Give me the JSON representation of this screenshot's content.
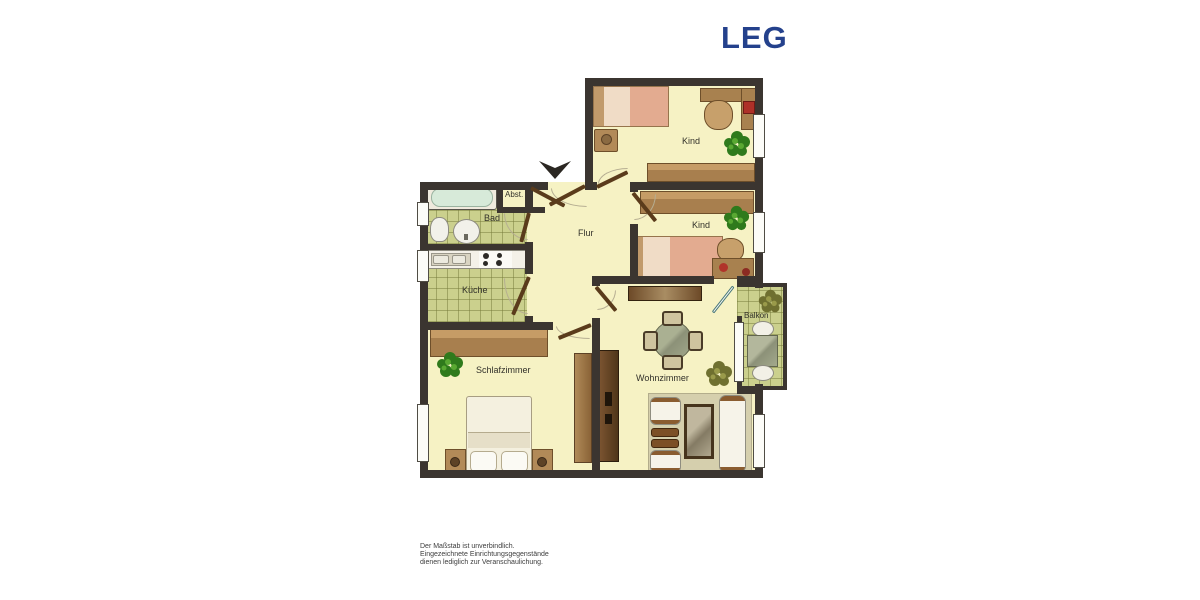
{
  "brand": {
    "logo": "LEG",
    "logo_color": "#24418c"
  },
  "floorplan": {
    "rooms": [
      {
        "id": "kind-1",
        "label": "Kind"
      },
      {
        "id": "kind-2",
        "label": "Kind"
      },
      {
        "id": "bad",
        "label": "Bad"
      },
      {
        "id": "abstellraum",
        "label": "Abst."
      },
      {
        "id": "flur",
        "label": "Flur"
      },
      {
        "id": "kueche",
        "label": "Küche"
      },
      {
        "id": "schlafzimmer",
        "label": "Schlafzimmer"
      },
      {
        "id": "wohnzimmer",
        "label": "Wohnzimmer"
      },
      {
        "id": "balkon",
        "label": "Balkon"
      }
    ],
    "icons": {
      "north_arrow": "triangle-arrow-down",
      "plants": "potted-plant",
      "furniture": [
        "bed",
        "nightstand",
        "desk",
        "desk-chair",
        "wardrobe",
        "bathtub",
        "toilet",
        "sink",
        "kitchen-counter",
        "stove",
        "dining-table",
        "chair",
        "sofa",
        "armchair",
        "coffee-table",
        "side-table",
        "balcony-table"
      ]
    },
    "colors": {
      "wall": "#3b3530",
      "room_floor": "#f6f2c4",
      "tile_floor": "#cbd08d",
      "bed_linen": "#e3ab90",
      "plant_green": "#2f7a1c"
    }
  },
  "footer": {
    "line1": "Der Maßstab ist unverbindlich.",
    "line2": "Eingezeichnete Einrichtungsgegenstände",
    "line3": "dienen lediglich zur Veranschaulichung."
  }
}
